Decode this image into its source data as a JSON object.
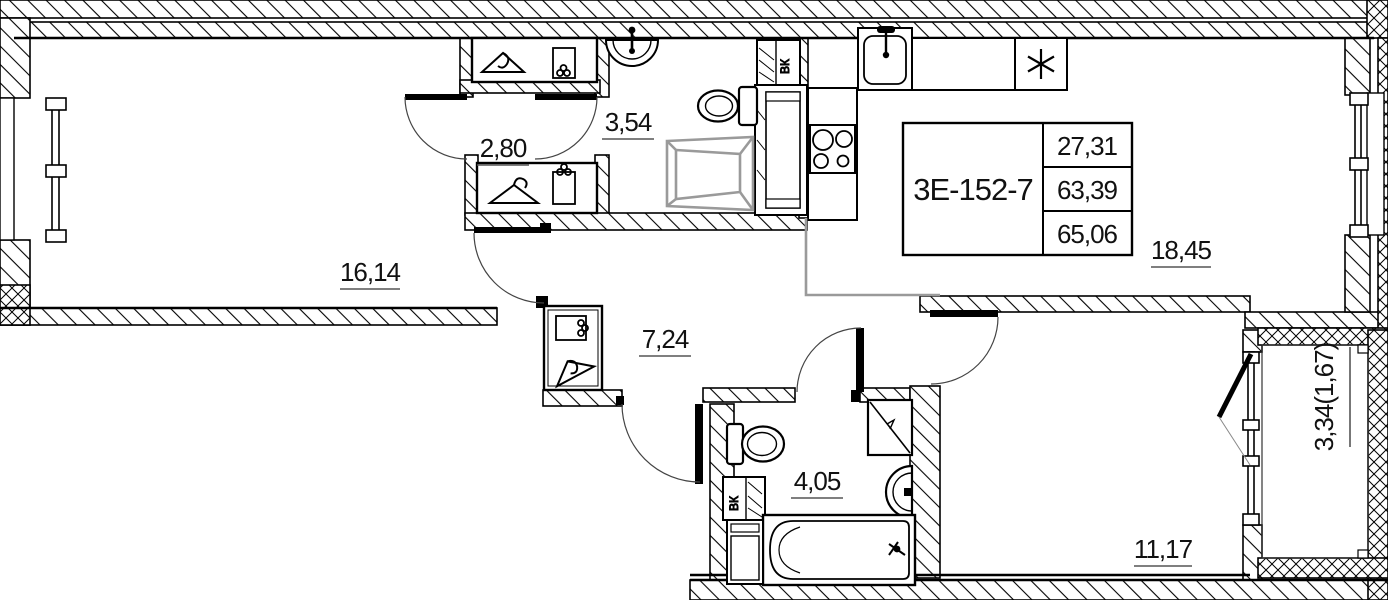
{
  "rooms": {
    "living": "16,14",
    "wardrobe": "2,80",
    "wc": "3,54",
    "hall": "7,24",
    "bathroom": "4,05",
    "kitchen_living": "18,45",
    "bedroom": "11,17",
    "balcony": "3,34(1,67)"
  },
  "unit": {
    "code": "3Е-152-7",
    "rows": [
      "27,31",
      "63,39",
      "65,06"
    ]
  },
  "labels": {
    "vent": "ВК"
  },
  "colors": {
    "line": "#000000",
    "zone_line": "#9a9a9a",
    "furniture_gray": "#9a9a9a",
    "background": "#ffffff"
  }
}
